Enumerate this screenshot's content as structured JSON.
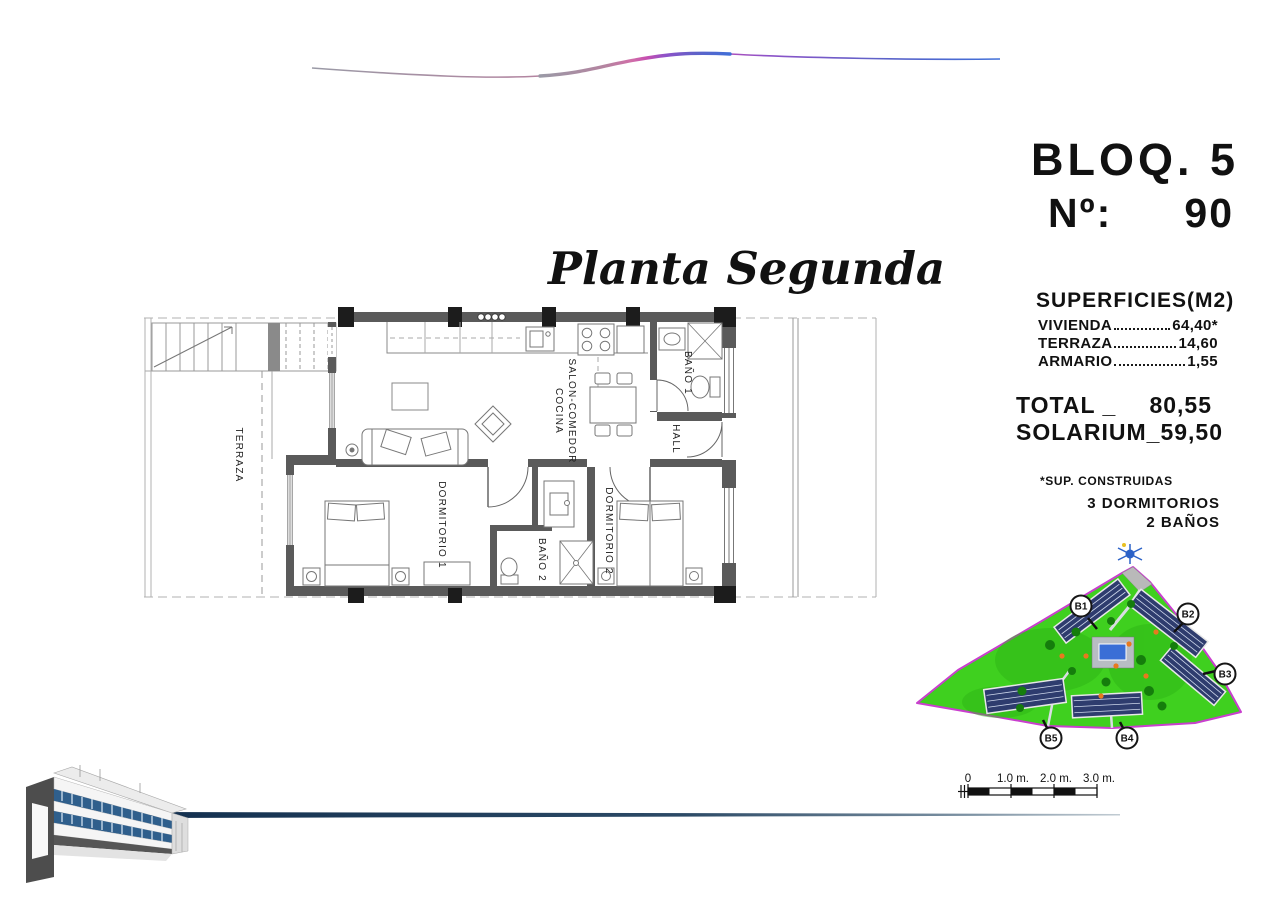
{
  "header": {
    "block": "BLOQ. 5",
    "unit_prefix": "Nº:",
    "unit_number": "90",
    "plan_title": "Planta Segunda"
  },
  "surfaces": {
    "title": "SUPERFICIES(M2)",
    "rows": [
      {
        "label": "VIVIENDA",
        "value": "64,40*"
      },
      {
        "label": "TERRAZA",
        "value": "14,60"
      },
      {
        "label": "ARMARIO",
        "value": "1,55"
      }
    ],
    "total_label": "TOTAL _",
    "total_value": "80,55",
    "solarium_label": "SOLARIUM_",
    "solarium_value": "59,50",
    "footnote": "*SUP. CONSTRUIDAS",
    "features": [
      "3 DORMITORIOS",
      "2 BAÑOS"
    ]
  },
  "floorplan": {
    "labels": {
      "terraza": "TERRAZA",
      "salon_line1": "SALON-COMEDOR",
      "salon_line2": "COCINA",
      "bano1": "BAÑO 1",
      "hall": "HALL",
      "dorm1": "DORMITORIO 1",
      "bano2": "BAÑO 2",
      "dorm2": "DORMITORIO 2"
    }
  },
  "siteplan": {
    "block_labels": [
      "B1",
      "B2",
      "B3",
      "B4",
      "B5"
    ],
    "colors": {
      "grass": "#3fd01f",
      "boundary": "#c93fce",
      "building": "#2e3c6e",
      "pool": "#3a6ed6"
    }
  },
  "scale_bar": {
    "labels": [
      "0",
      "1.0 m.",
      "2.0 m.",
      "3.0 m."
    ]
  },
  "footer": {
    "line_color": "#16365c"
  }
}
